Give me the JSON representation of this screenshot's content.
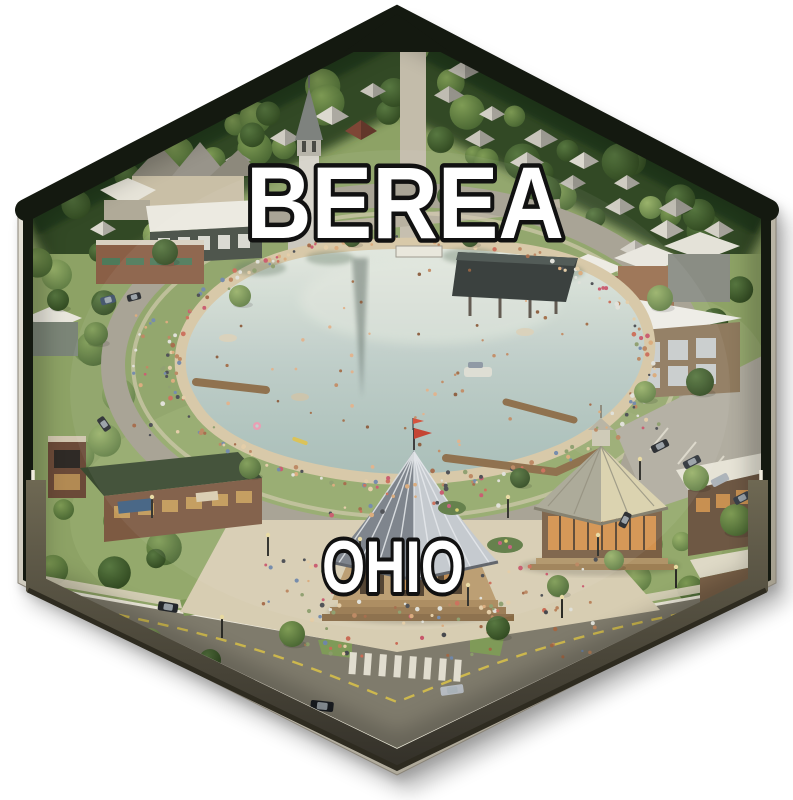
{
  "badge": {
    "city_label": "BEREA",
    "state_label": "OHIO"
  },
  "colors": {
    "bezel_light": "#f0ede3",
    "bezel_dark": "#9b9584",
    "frame_dark": "#141910",
    "tile_side": "#6e6853",
    "tile_side_dark": "#35322a",
    "water": "#b9c9c4",
    "water_light": "#e0e6dc",
    "water_deep": "#a5bcb5",
    "sand": "#d6c6a4",
    "grass": "#8da265",
    "canopy": "#2e4522",
    "road": "#a49f90",
    "road_main": "#7f7b6c",
    "plaza": "#d7cdb2",
    "line_white": "#efebdd",
    "line_yellow": "#cdb84e",
    "text_fill": "#ffffff",
    "text_outline": "#111111"
  }
}
